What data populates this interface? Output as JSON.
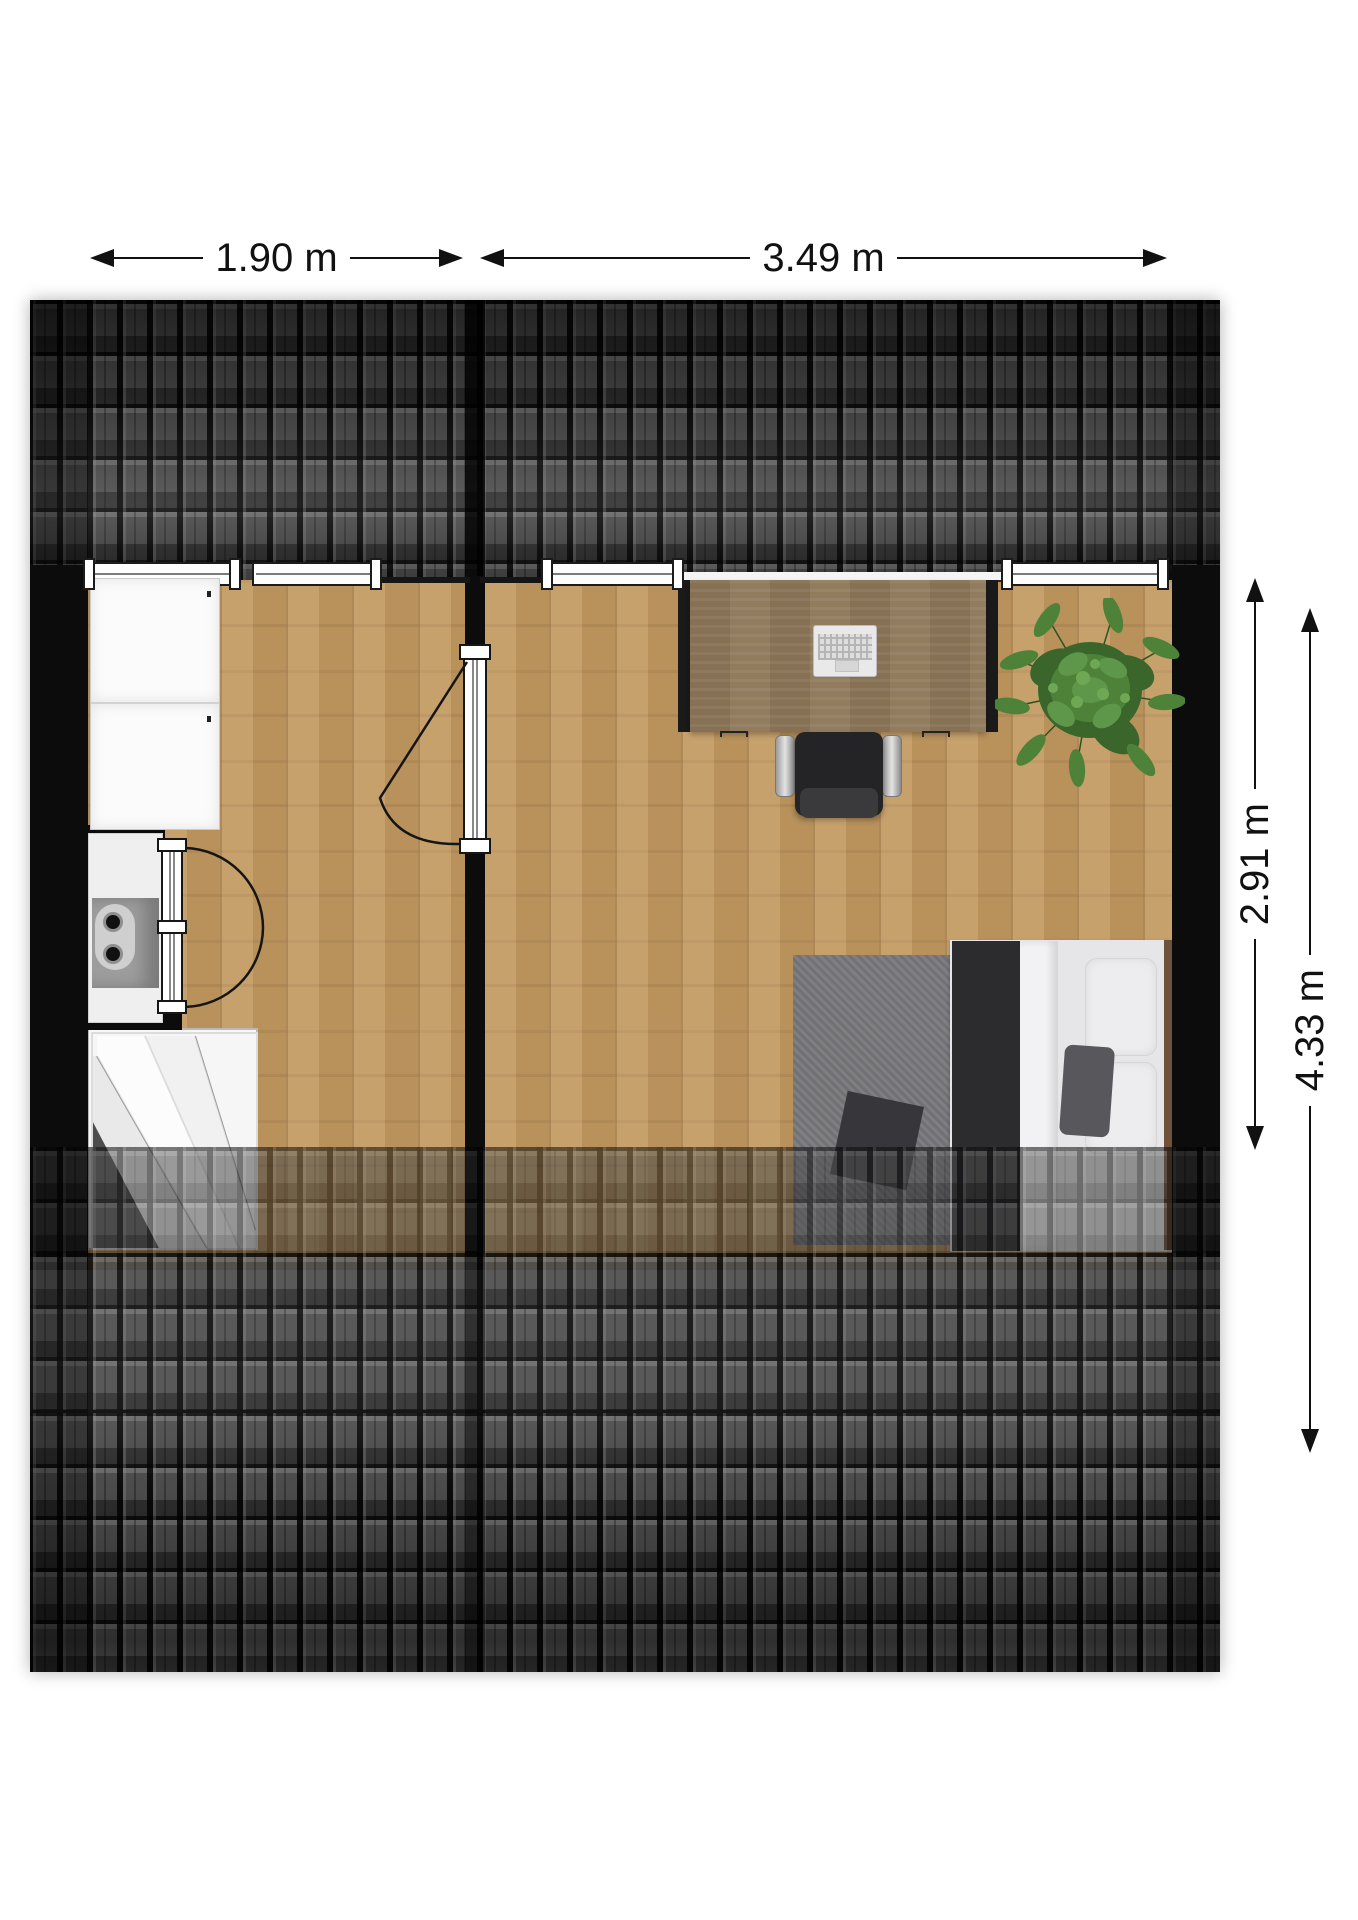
{
  "title": "Attic floor plan",
  "dimensions": {
    "room_left_width": "1.90 m",
    "room_right_width": "3.49 m",
    "room_depth_inner": "2.91 m",
    "total_depth": "4.33 m"
  },
  "palette": {
    "background": "#ffffff",
    "roof_tile": "#4b4b4b",
    "wall_black": "#0c0c0c",
    "floor_wood": "#c39a61",
    "desk_wood": "#8d7758",
    "plant_green": "#4e8238",
    "rug_grey": "#78787c",
    "bed_white": "#e6e6e8",
    "dimension_text": "#111111"
  }
}
